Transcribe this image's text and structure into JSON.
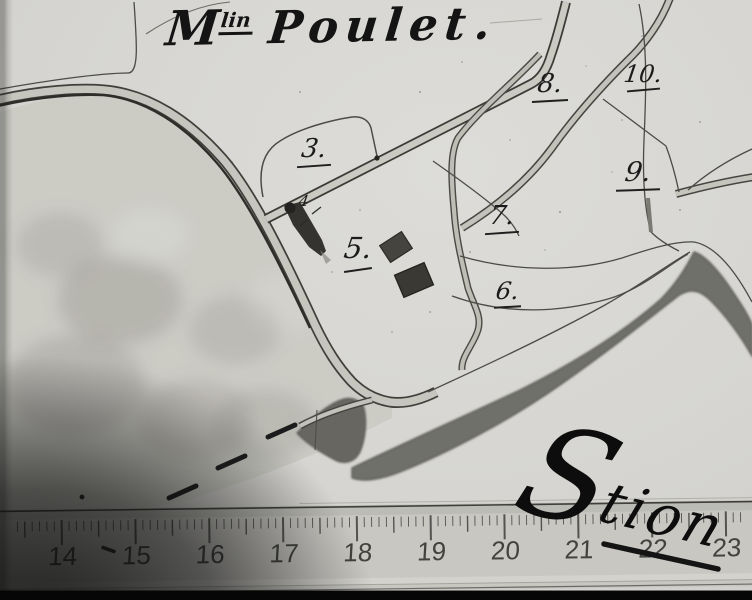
{
  "map": {
    "title": {
      "m": "M",
      "sup": "lin",
      "rest": "Poulet",
      "period": "."
    },
    "parcels": [
      {
        "label": "3."
      },
      {
        "label": "4"
      },
      {
        "label": "5."
      },
      {
        "label": "6."
      },
      {
        "label": "7."
      },
      {
        "label": "8."
      },
      {
        "label": "9."
      },
      {
        "label": "10."
      }
    ],
    "script_annotation": {
      "initial": "S",
      "rest": "tion"
    },
    "ruler": {
      "numbers": [
        14,
        15,
        16,
        17,
        18,
        19,
        20,
        21,
        22,
        23
      ]
    }
  },
  "colors": {
    "paper": "#d6d5d1",
    "ink": "#2b2b2b",
    "river": "#706f6b",
    "road_fill": "#c7c6be",
    "shadow": "#0c0c0c"
  }
}
